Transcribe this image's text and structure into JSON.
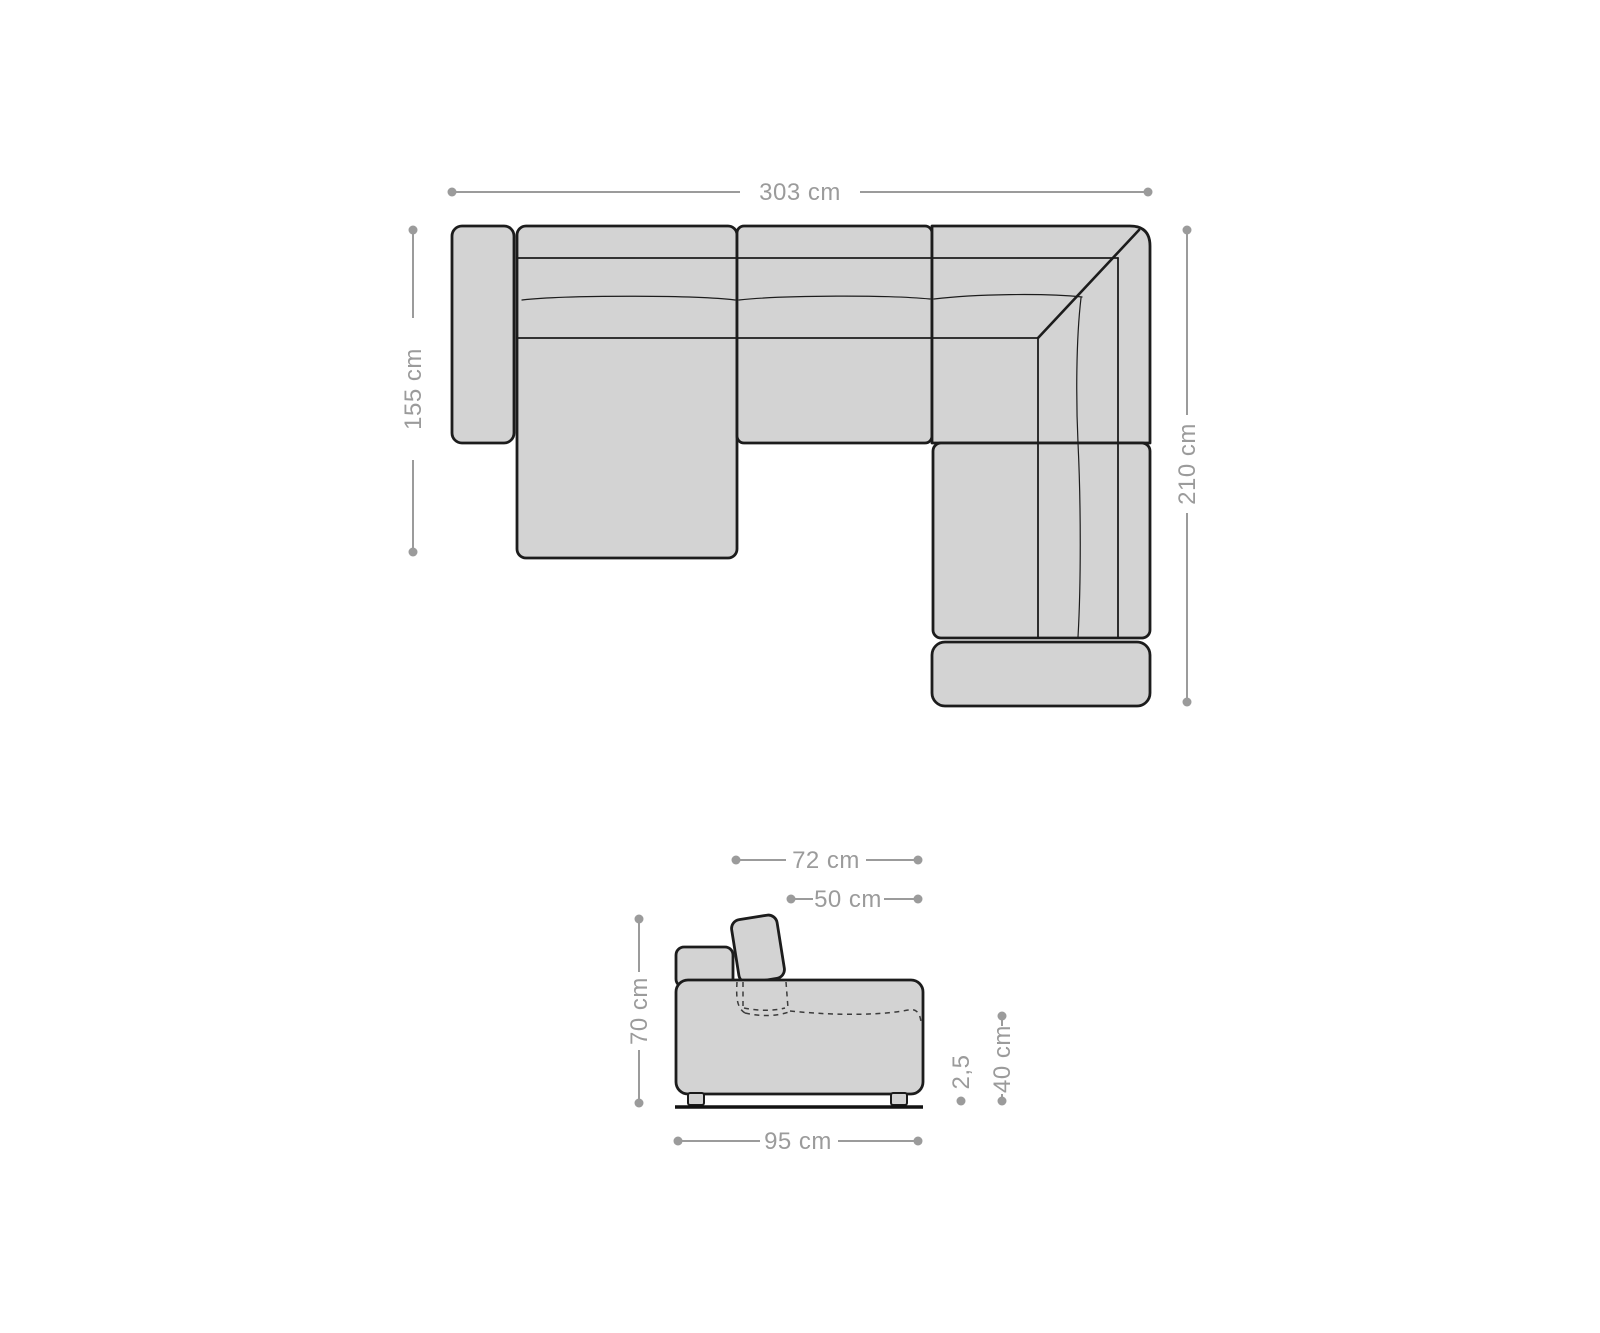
{
  "colors": {
    "background": "#ffffff",
    "sofa_fill": "#d3d3d3",
    "sofa_outline": "#1c1c1c",
    "dim": "#9b9b9b"
  },
  "top_view": {
    "overall_width": "303 cm",
    "chaise_depth": "155 cm",
    "corner_depth": "210 cm"
  },
  "side_view": {
    "depth_with_headrest": "72 cm",
    "seat_depth": "50 cm",
    "total_height": "70 cm",
    "total_depth": "95 cm",
    "foot_height": "2,5",
    "seat_height": "40 cm"
  }
}
